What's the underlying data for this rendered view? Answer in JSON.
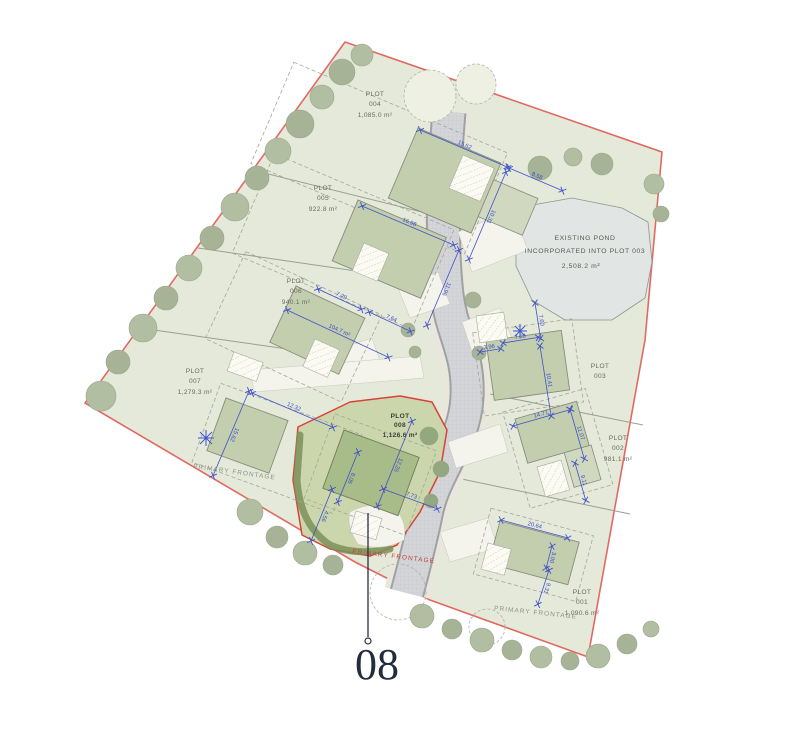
{
  "title": "Site plan with plots 001-008",
  "callout": {
    "number": "08"
  },
  "pond": {
    "line1": "EXISTING POND",
    "line2": "INCORPORATED INTO PLOT 003",
    "area": "2,508.2 m²"
  },
  "frontage": {
    "left": "PRIMARY FRONTAGE",
    "plot008": "PRIMARY FRONTAGE",
    "bottom": "PRIMARY FRONTAGE"
  },
  "plots": [
    {
      "title": "PLOT",
      "number": "001",
      "area": "1,090.6 m²",
      "dims": [
        "20.64",
        "3.00",
        "9.31"
      ]
    },
    {
      "title": "PLOT",
      "number": "002",
      "area": "981.1 m²",
      "dims": [
        "14.77",
        "11.07",
        "9.11"
      ]
    },
    {
      "title": "PLOT",
      "number": "003",
      "area": "",
      "dims": [
        "7.50",
        "3.96",
        "7.60",
        "10.41"
      ]
    },
    {
      "title": "PLOT",
      "number": "004",
      "area": "1,085.0 m²",
      "dims": [
        "15.62",
        "8.58",
        "10.31"
      ]
    },
    {
      "title": "PLOT",
      "number": "005",
      "area": "922.8 m²",
      "dims": [
        "16.98",
        "11.96"
      ]
    },
    {
      "title": "PLOT",
      "number": "006",
      "area": "940.1 m²",
      "dims": [
        "7.29",
        "7.64",
        "104.7 m²"
      ]
    },
    {
      "title": "PLOT",
      "number": "007",
      "area": "1,279.3 m²",
      "dims": [
        "12.32",
        "15.62"
      ]
    },
    {
      "title": "PLOT",
      "number": "008",
      "area": "1,126.6 m²",
      "dims": [
        "12.25",
        "6.05",
        "7.73",
        "4.56"
      ]
    }
  ],
  "colors": {
    "boundary_red": "#e06a62",
    "dimension_blue": "#4052c8",
    "site_green": "#e5e9da",
    "highlight_plot_green": "#ccd6ac",
    "pond_grey_blue": "#e1e6e4",
    "road_grey": "#d4d5d8",
    "callout_ink": "#232c3d"
  }
}
